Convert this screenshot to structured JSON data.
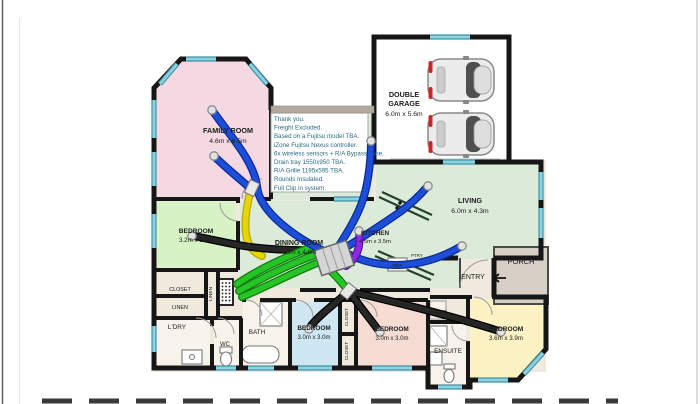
{
  "colors": {
    "wall": "#161616",
    "window_edge": "#3f93a8",
    "window_glass": "#8ed2e0",
    "family_fill": "#f4d9e3",
    "bedroom1_fill": "#d7f2c4",
    "openplan_fill": "#dcead9",
    "bedroom2_fill": "#cfe7f2",
    "bedroom3_fill": "#f6dcd3",
    "bedroom4_fill": "#fcf2c4",
    "hall_fill": "#f0e9de",
    "wet_fill": "#f7f3ea",
    "garage_fill": "#ffffff",
    "porch_fill": "#d8d0c7",
    "duct_blue": "#1d4ed8",
    "duct_green": "#26c427",
    "duct_yellow": "#e6d600",
    "duct_purple": "#8a2be2",
    "duct_black": "#262626",
    "notes_text": "#2a6b85",
    "notes_bar": "#b3a99d"
  },
  "notes": {
    "lines": [
      "Thank you.",
      "Freight Excluded.",
      "Based on a Fujitsu model TBA.",
      "iZone Fujitsu Nexus controller.",
      "6x wireless sensors + R/A Bypass zone.",
      "Drain tray 1550x950 TBA.",
      "R/A Grille 1195x595 TBA.",
      "Rounds Insulated.",
      "Full Clip in system."
    ]
  },
  "rooms": {
    "family": {
      "name": "FAMILY ROOM",
      "dims": "4.6m x 6.5m"
    },
    "garage": {
      "name_line1": "DOUBLE",
      "name_line2": "GARAGE",
      "dims": "6.0m x 5.6m"
    },
    "living": {
      "name": "LIVING",
      "dims": "6.0m x 4.3m"
    },
    "dining": {
      "name": "DINING ROOM",
      "dims": "4.5m x 4.0m"
    },
    "kitchen": {
      "name": "KITCHEN",
      "dims": "4.5m x 3.5m"
    },
    "bedroom1": {
      "name": "BEDROOM",
      "dims": "3.2m x 3.2m"
    },
    "bedroom2": {
      "name": "BEDROOM",
      "dims": "3.0m x 3.0m"
    },
    "bedroom3": {
      "name": "BEDROOM",
      "dims": "3.0m x 3.0m"
    },
    "bedroom4": {
      "name": "BEDROOM",
      "dims": "3.6m x 3.9m"
    },
    "laundry": {
      "name": "L'DRY"
    },
    "wc": {
      "name": "WC"
    },
    "bath": {
      "name": "BATH"
    },
    "ensuite": {
      "name": "ENSUITE"
    },
    "entry": {
      "name": "ENTRY"
    },
    "porch": {
      "name": "PORCH"
    }
  },
  "labels": {
    "closet": "CLOSET",
    "linen": "LINEN",
    "ref": "REF",
    "pantry": "PTRY"
  }
}
